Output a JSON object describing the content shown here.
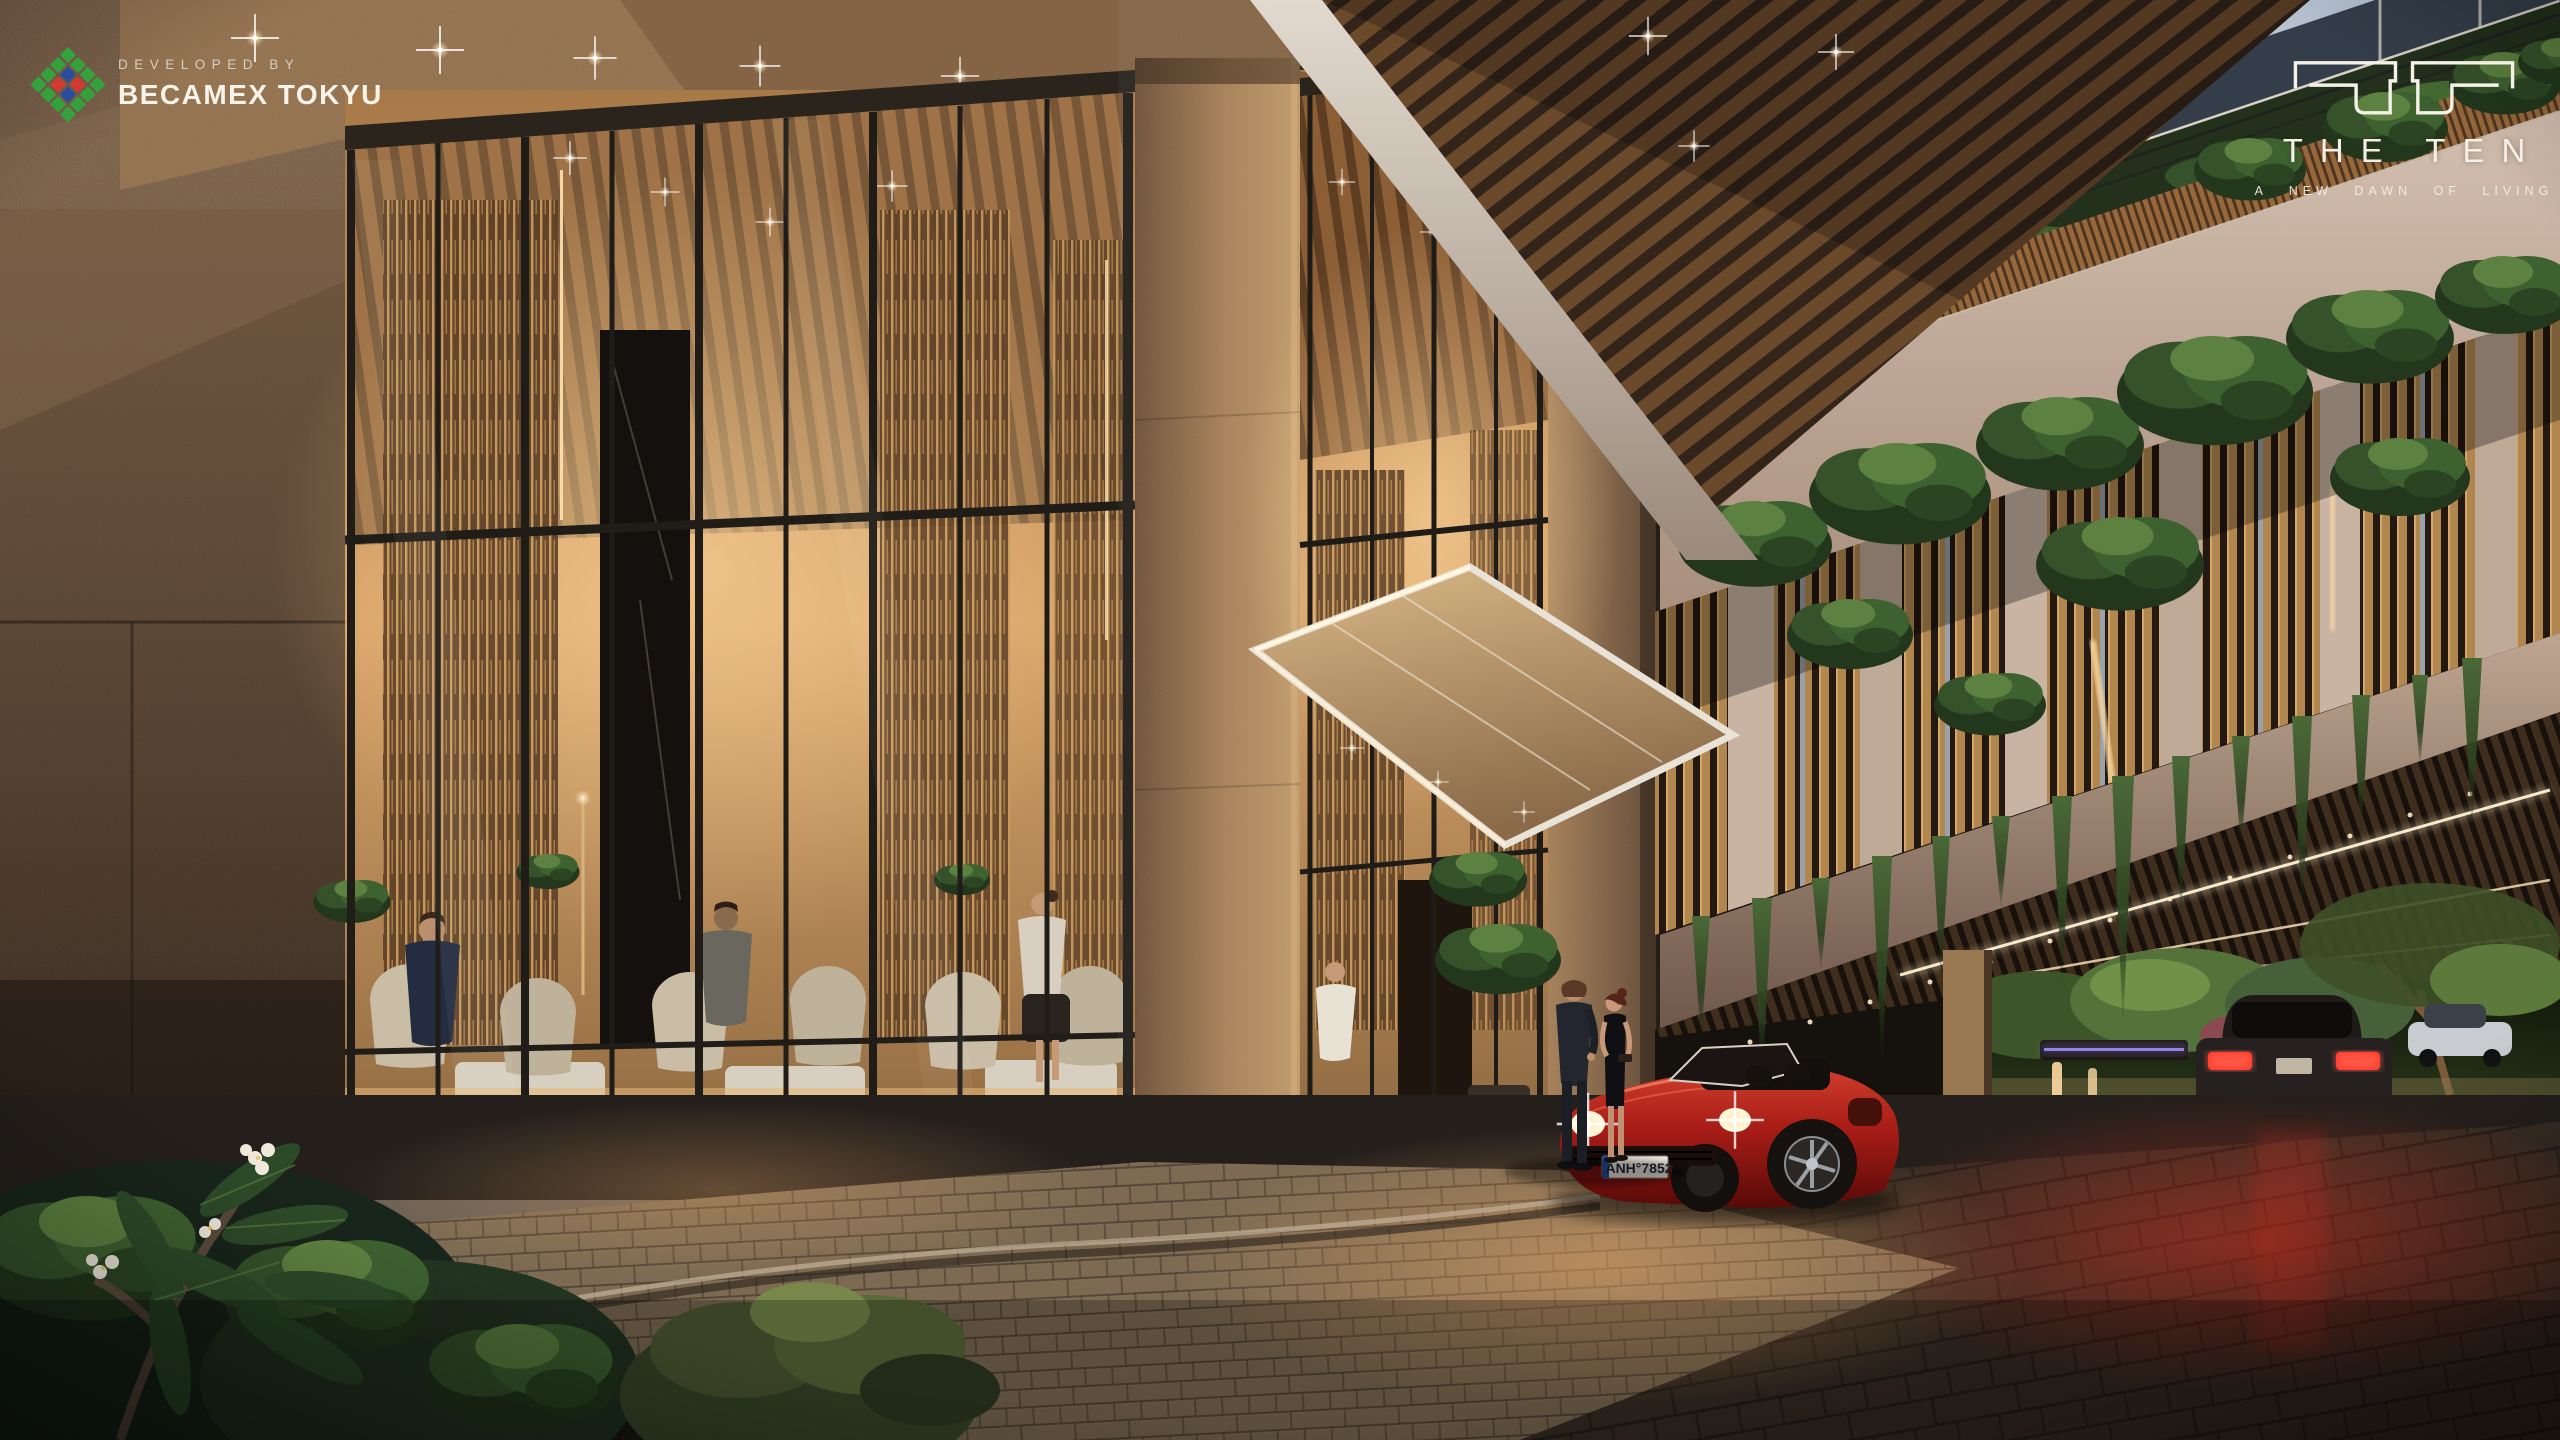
{
  "scene": {
    "type": "architectural-render",
    "time_of_day": "dusk",
    "subject": "Residential tower entrance drop-off with double-height glass lobby, granite columns, louvered facade with hanging gardens, porte-cochere drive-through and a red convertible sports car"
  },
  "developer_badge": {
    "pretitle": "DEVELOPED BY",
    "name": "BECAMEX TOKYU",
    "logo": {
      "icon": "diamond-mosaic-logo",
      "green": "#35a13d",
      "blue": "#2b4da0",
      "red": "#d43a31"
    }
  },
  "project_logo": {
    "icon": "ten-monogram",
    "name": "THE TEN",
    "tagline": "A NEW DAWN OF LIVING",
    "color": "#f4f0e7"
  },
  "vehicles": {
    "sports_car": {
      "type": "red convertible",
      "license_plate": "ANH°7852",
      "body_color": "#a81c17"
    },
    "departing_car": {
      "type": "dark sedan with lit taillights"
    }
  },
  "palette": {
    "stone": "#a5815c",
    "wood": "#8a5c33",
    "foliage": "#3c5629",
    "interior_glow": "#e8b877",
    "pavement": "#2e2823",
    "cream_fascia": "#cdb9ab",
    "sky": "#b7c3d3"
  }
}
